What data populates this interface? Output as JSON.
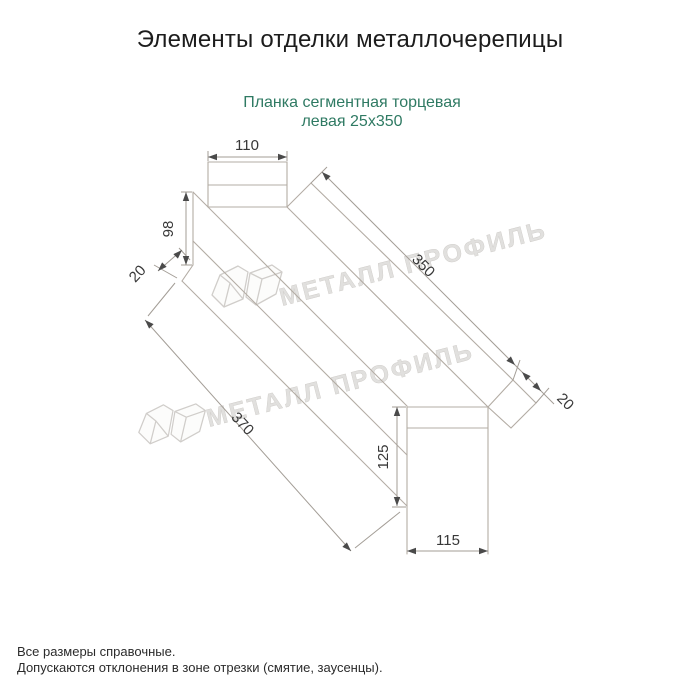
{
  "page": {
    "title": "Элементы отделки металлочерепицы"
  },
  "product": {
    "subtitle_line1": "Планка сегментная торцевая",
    "subtitle_line2": "левая 25х350"
  },
  "drawing": {
    "type": "flat-pattern technical drawing",
    "dimensions": {
      "head_width": "110",
      "head_height": "98",
      "head_lip": "20",
      "top_edge_length": "350",
      "bottom_edge_length": "370",
      "end_tab": "20",
      "end_height": "125",
      "end_width": "115"
    }
  },
  "watermark": {
    "text": "МЕТАЛЛ ПРОФИЛЬ",
    "logo": "metall-profil-gem-icon",
    "color": "#dedddb"
  },
  "footnotes": {
    "line1": "Все размеры справочные.",
    "line2": "Допускаются отклонения в зоне отрезки (смятие, заусенцы)."
  },
  "colors": {
    "subtitle": "#2f7a63",
    "shape_line": "#b3aca4",
    "dim_line": "#a39d96",
    "dim_text": "#383838"
  }
}
